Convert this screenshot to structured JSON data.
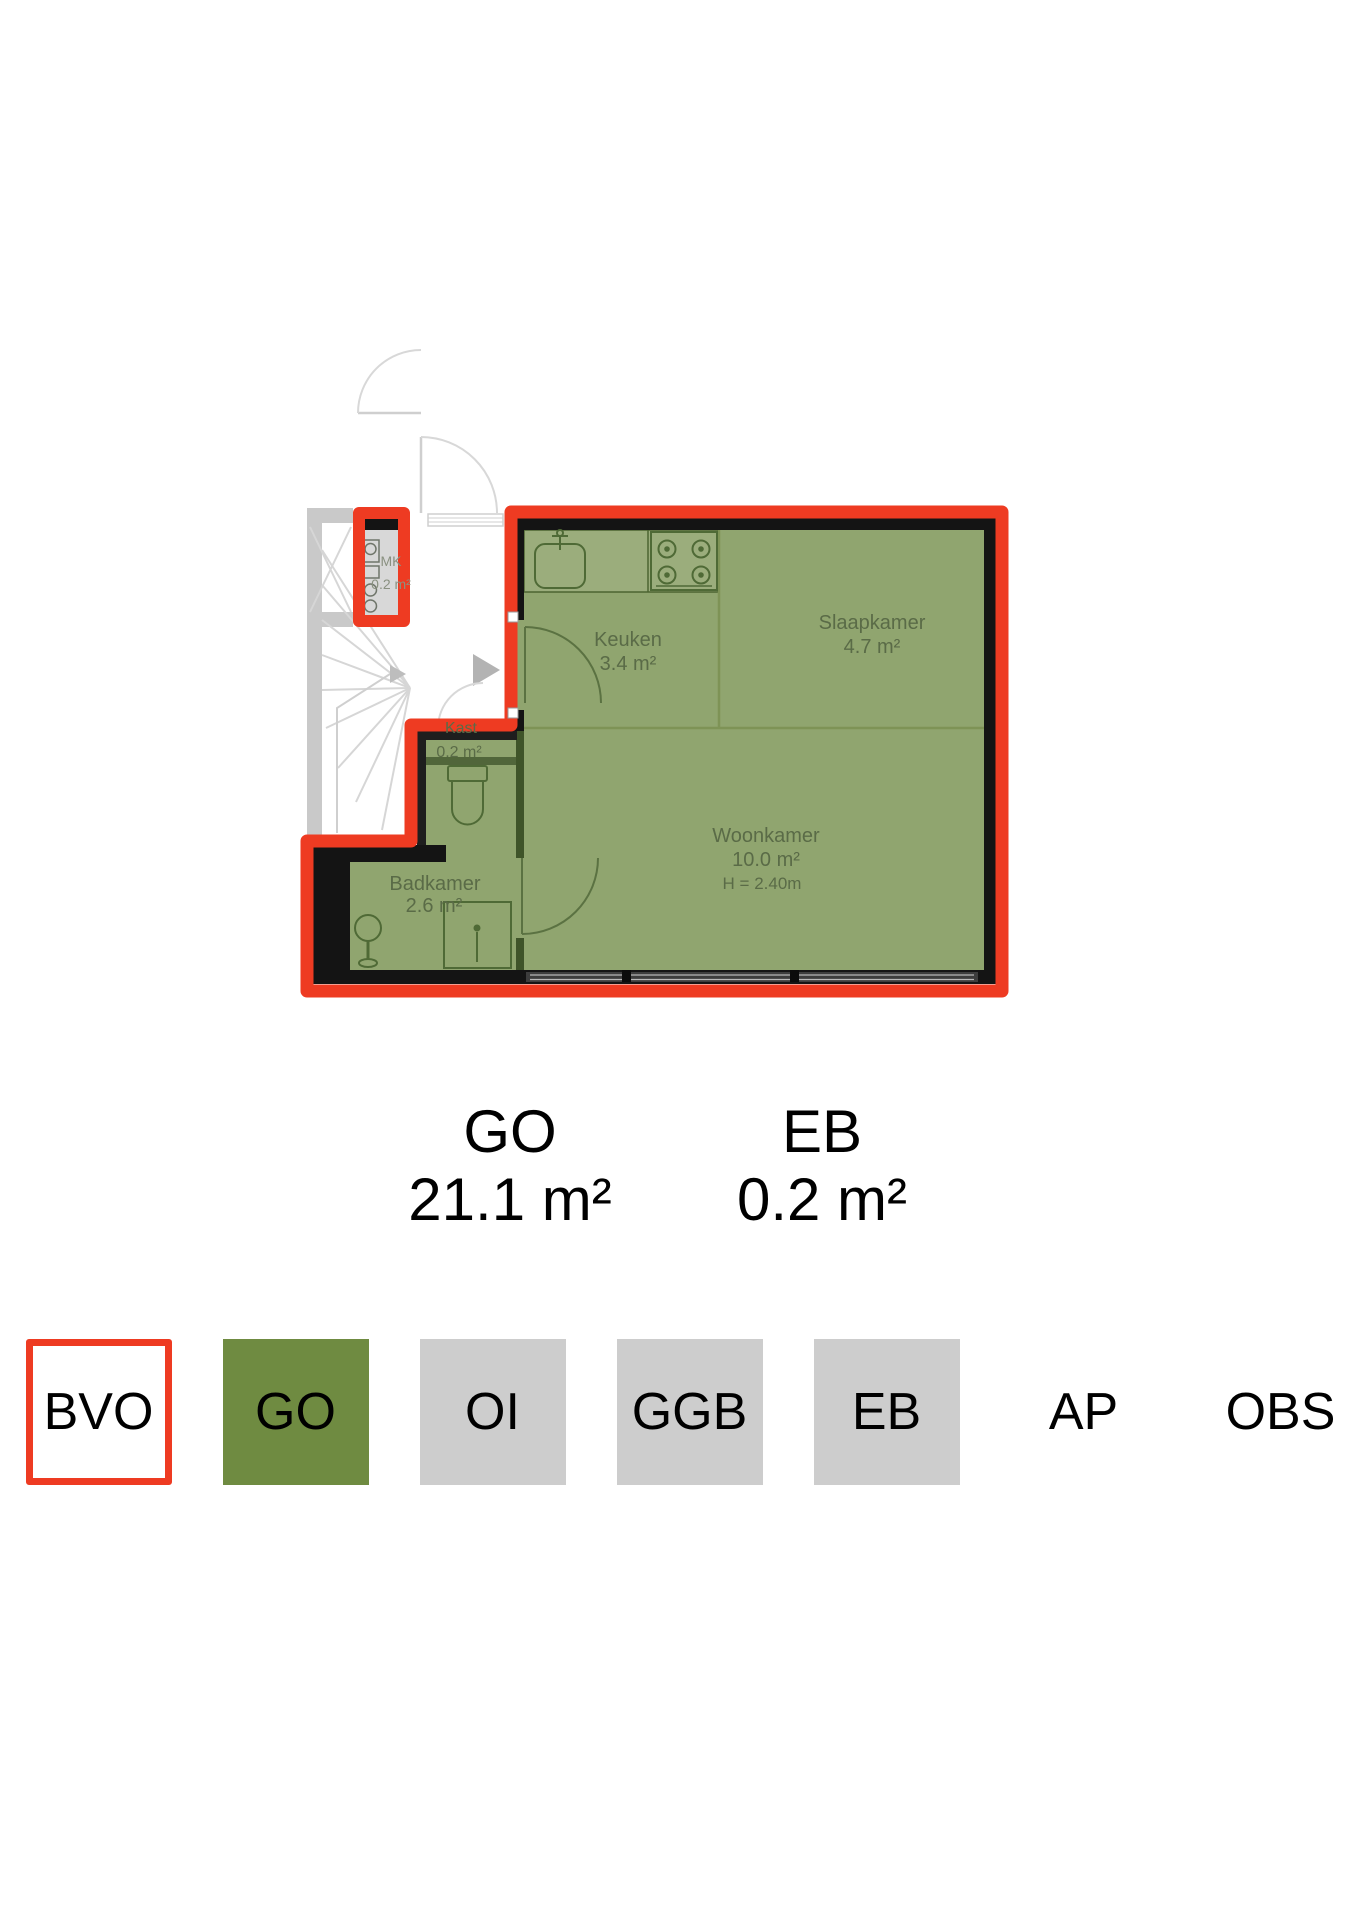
{
  "plan": {
    "rooms": {
      "mk": {
        "label": "MK",
        "area": "0.2 m²"
      },
      "keuken": {
        "label": "Keuken",
        "area": "3.4 m²"
      },
      "slaapkamer": {
        "label": "Slaapkamer",
        "area": "4.7 m²"
      },
      "kast": {
        "label": "Kast",
        "area": "0.2 m²"
      },
      "woonkamer": {
        "label": "Woonkamer",
        "area": "10.0 m²",
        "ceiling_height": "H = 2.40m"
      },
      "badkamer": {
        "label": "Badkamer",
        "area": "2.6 m²"
      }
    }
  },
  "summary": {
    "go": {
      "label": "GO",
      "value": "21.1 m²"
    },
    "eb": {
      "label": "EB",
      "value": "0.2 m²"
    }
  },
  "legend": {
    "items": [
      {
        "label": "BVO",
        "swatch": "bvo-outline"
      },
      {
        "label": "GO",
        "swatch": "green"
      },
      {
        "label": "OI",
        "swatch": "gray"
      },
      {
        "label": "GGB",
        "swatch": "gray"
      },
      {
        "label": "EB",
        "swatch": "gray"
      },
      {
        "label": "AP",
        "swatch": "none"
      },
      {
        "label": "OBS",
        "swatch": "none"
      }
    ]
  },
  "colors": {
    "bvo_red": "#ee3b22",
    "go_green_plan": "#90a56f",
    "go_green_legend": "#6f8b41",
    "legend_gray": "#cdcdcd"
  }
}
